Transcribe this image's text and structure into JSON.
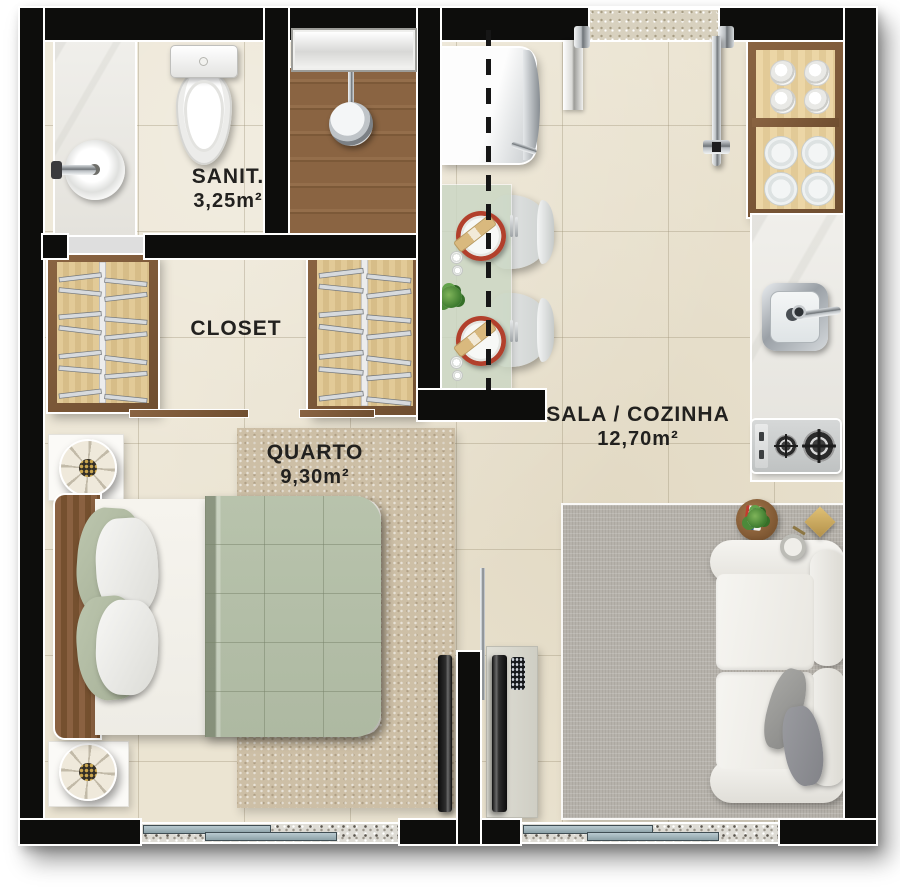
{
  "title": "Apartment floor plan",
  "rooms": [
    {
      "name": "SANIT.",
      "area": "3,25m²"
    },
    {
      "name": "CLOSET",
      "area": ""
    },
    {
      "name": "QUARTO",
      "area": "9,30m²"
    },
    {
      "name": "SALA / COZINHA",
      "area": "12,70m²"
    }
  ],
  "colors": {
    "wall": "#0d0d0c",
    "floor_tile": "#ebe4d2",
    "wood": "#8a6442",
    "wardrobe_interior": "#dcc493",
    "bedspread": "#b6c1ab",
    "rug_bedroom": "#cdbfa6",
    "rug_living": "#b6b2ab",
    "dining_table": "#ccd5c5",
    "charger_plate": "#b2402c",
    "napkin": "#d9b97e",
    "gold_lamp": "#c9a457",
    "window_pane": "#a8babf",
    "granite_sill": "#dedcd5"
  }
}
